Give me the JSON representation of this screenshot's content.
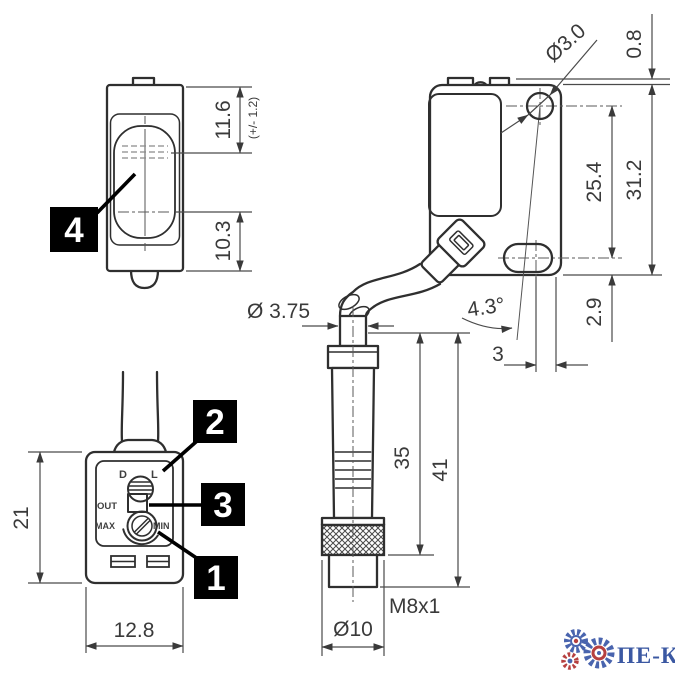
{
  "front_view": {
    "callout": "4",
    "dim_height_top": "11.6",
    "tolerance": "(+/- 1.2)",
    "dim_height_bottom": "10.3"
  },
  "side_view": {
    "hole_diameter": "Ø3.0",
    "dim_tab": "0.8",
    "dim_hole_spacing": "25.4",
    "dim_total_height": "31.2",
    "beam_angle": "4.3°",
    "dim_slot_to_bottom": "2.9",
    "dim_axis_offset": "3",
    "cable_diameter": "Ø 3.75"
  },
  "connector_view": {
    "dim_body_length": "35",
    "dim_total_length": "41",
    "dim_diameter": "Ø10",
    "thread_spec": "M8x1"
  },
  "top_view": {
    "callout_adjuster": "1",
    "callout_selector": "2",
    "callout_indicator": "3",
    "dim_depth": "21",
    "dim_width": "12.8",
    "selector_left": "D",
    "selector_right": "L",
    "output_label": "OUT",
    "pot_max": "MAX",
    "pot_min": "MIN"
  },
  "watermark": {
    "brand": "ПЕ-КО",
    "brand_color": "#2b4a9b"
  }
}
